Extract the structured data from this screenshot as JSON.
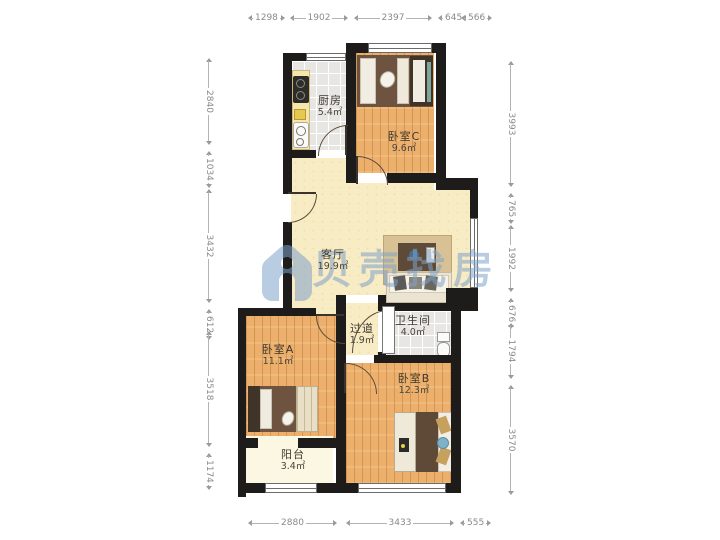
{
  "watermark": {
    "brand": "贝壳找房",
    "logo": "beike-shell-logo",
    "color": "#7ea3ca"
  },
  "rooms": {
    "kitchen": {
      "name": "厨房",
      "area": "5.4㎡"
    },
    "bedroom_c": {
      "name": "卧室C",
      "area": "9.6㎡"
    },
    "living_room": {
      "name": "客厅",
      "area": "19.9㎡"
    },
    "hallway": {
      "name": "过道",
      "area": "1.9㎡"
    },
    "bathroom": {
      "name": "卫生间",
      "area": "4.0㎡"
    },
    "bedroom_a": {
      "name": "卧室A",
      "area": "11.1㎡"
    },
    "bedroom_b": {
      "name": "卧室B",
      "area": "12.3㎡"
    },
    "balcony": {
      "name": "阳台",
      "area": "3.4㎡"
    }
  },
  "dims": {
    "top": [
      "1298",
      "1902",
      "2397",
      "645",
      "566"
    ],
    "bottom": [
      "2880",
      "3433",
      "555"
    ],
    "left": [
      "2840",
      "1034",
      "3432",
      "612",
      "3518",
      "1174"
    ],
    "right": [
      "3993",
      "765",
      "1992",
      "676",
      "1794",
      "3570"
    ]
  },
  "colors": {
    "wall": "#1d1c1a",
    "wood_floor": "#ecb06c",
    "living_floor": "#f8ecc5",
    "tile_floor": "#e7e6e2",
    "balcony_floor": "#fcf7e2"
  }
}
